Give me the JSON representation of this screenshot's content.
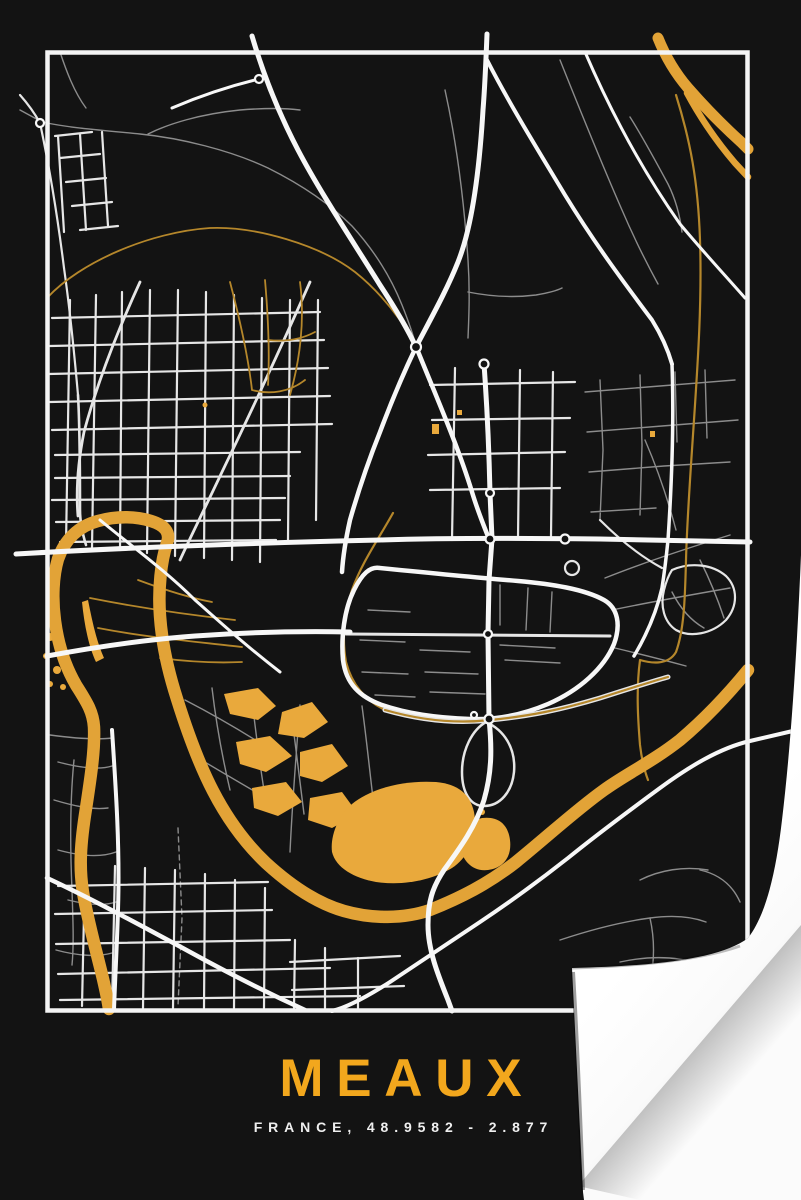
{
  "poster": {
    "title": "MEAUX",
    "subtitle": "FRANCE, 48.9582 - 2.877",
    "colors": {
      "page_background": "#FBFBFB",
      "poster_background": "#131313",
      "frame": "#F4F4F4",
      "title_gold": "#F2A71D",
      "subtitle_text": "#EFEFEF",
      "river_gold": "#E2A337",
      "gold_fill": "#E9A93C",
      "gold_road": "#B5872B",
      "road_white": "#F7F7F7",
      "road_mid": "#E6E6E6",
      "road_gray": "#8C8C8C"
    }
  }
}
